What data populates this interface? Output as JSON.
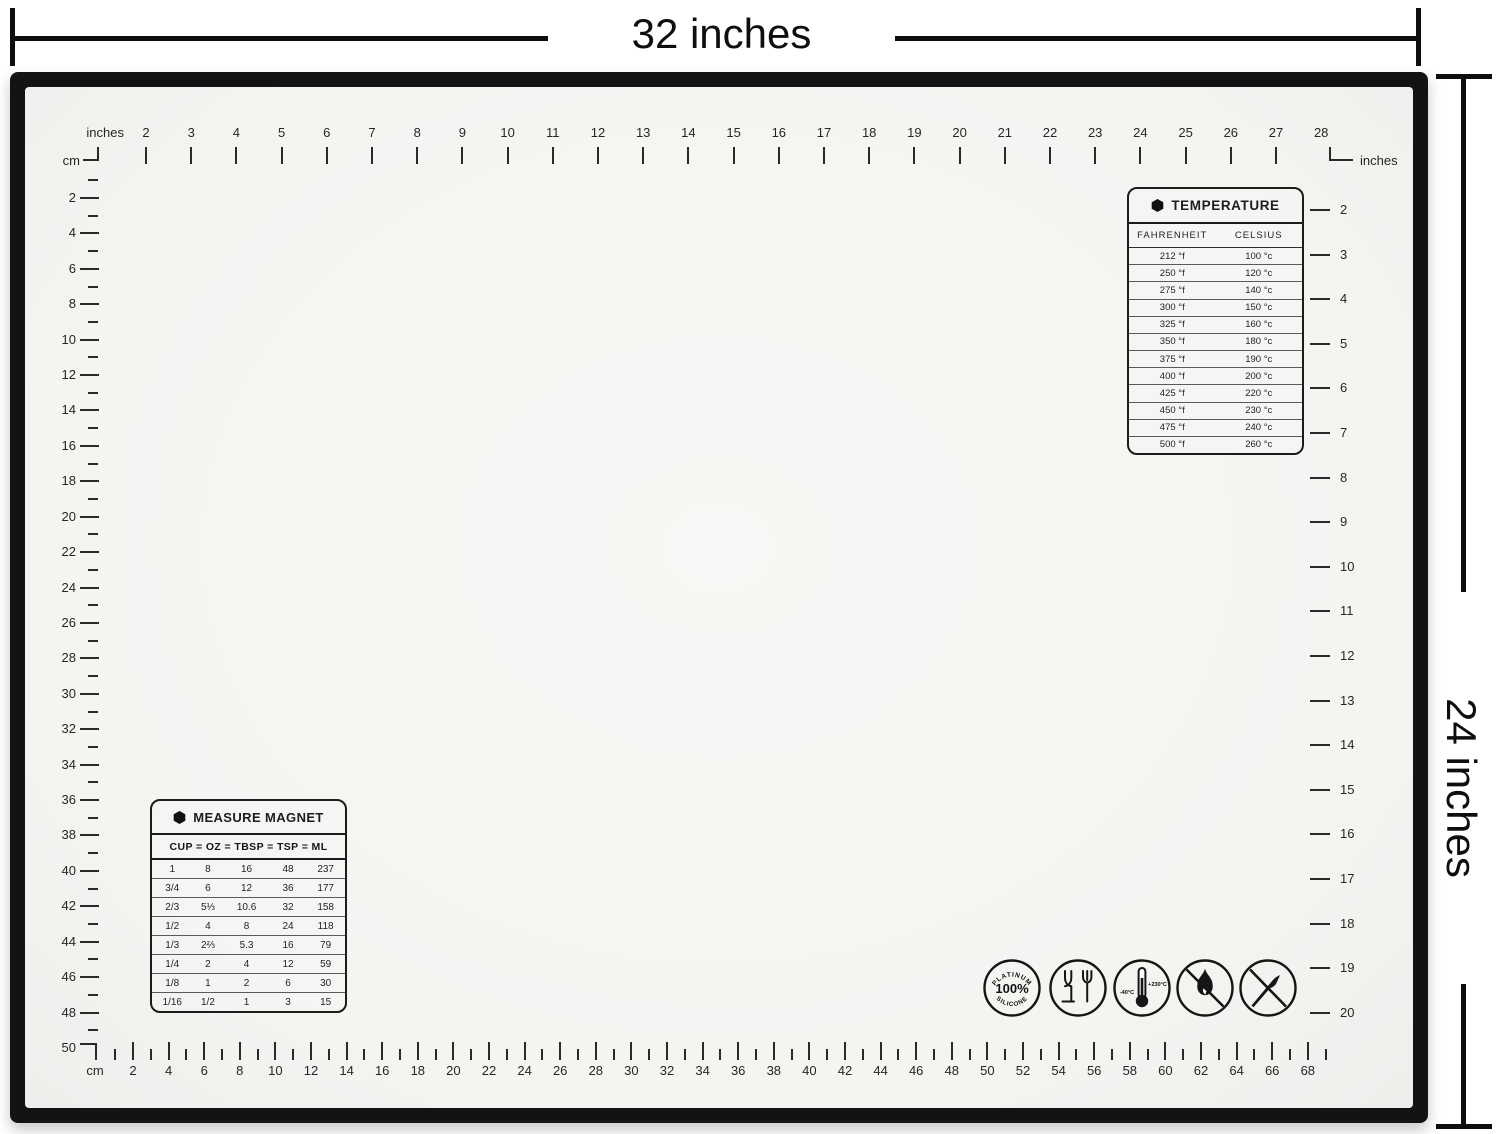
{
  "dimensions": {
    "width_label": "32 inches",
    "height_label": "24 inches"
  },
  "rulers": {
    "top": {
      "unit_label": "inches",
      "numbers": [
        2,
        3,
        4,
        5,
        6,
        7,
        8,
        9,
        10,
        11,
        12,
        13,
        14,
        15,
        16,
        17,
        18,
        19,
        20,
        21,
        22,
        23,
        24,
        25,
        26,
        27,
        28
      ]
    },
    "left": {
      "unit_label": "cm",
      "numbers": [
        2,
        4,
        6,
        8,
        10,
        12,
        14,
        16,
        18,
        20,
        22,
        24,
        26,
        28,
        30,
        32,
        34,
        36,
        38,
        40,
        42,
        44,
        46,
        48,
        50
      ]
    },
    "right": {
      "unit_label": "inches",
      "numbers": [
        2,
        3,
        4,
        5,
        6,
        7,
        8,
        9,
        10,
        11,
        12,
        13,
        14,
        15,
        16,
        17,
        18,
        19,
        20
      ]
    },
    "bottom": {
      "unit_label": "cm",
      "numbers": [
        2,
        4,
        6,
        8,
        10,
        12,
        14,
        16,
        18,
        20,
        22,
        24,
        26,
        28,
        30,
        32,
        34,
        36,
        38,
        40,
        42,
        44,
        46,
        48,
        50,
        52,
        54,
        56,
        58,
        60,
        62,
        64,
        66,
        68
      ]
    }
  },
  "circle_guide": {
    "left_unit_label": "inches",
    "right_unit_label": "cm",
    "inch_labels": [
      "18\"",
      "17\"",
      "16\"",
      "15\"",
      "14\"",
      "13\"",
      "12\"",
      "11\"",
      "10\"",
      "9\"",
      "8\"",
      "7\""
    ],
    "inch_diameters": [
      18,
      17,
      16,
      15,
      14,
      13,
      12,
      11,
      10,
      9,
      8,
      7
    ],
    "cm_labels": [
      "17.5",
      "20",
      "22.5",
      "25",
      "27.5",
      "30",
      "32.5",
      "35",
      "37.5",
      "40",
      "42.5",
      "45"
    ],
    "cm_ring_diameters": [
      7,
      8,
      9,
      10,
      11,
      12,
      13,
      14,
      15,
      16,
      17,
      18
    ]
  },
  "temperature_table": {
    "title": "TEMPERATURE",
    "columns": [
      "FAHRENHEIT",
      "CELSIUS"
    ],
    "rows": [
      [
        "212 °f",
        "100 °c"
      ],
      [
        "250 °f",
        "120 °c"
      ],
      [
        "275 °f",
        "140 °c"
      ],
      [
        "300 °f",
        "150 °c"
      ],
      [
        "325 °f",
        "160 °c"
      ],
      [
        "350 °f",
        "180 °c"
      ],
      [
        "375 °f",
        "190 °c"
      ],
      [
        "400 °f",
        "200 °c"
      ],
      [
        "425 °f",
        "220 °c"
      ],
      [
        "450 °f",
        "230 °c"
      ],
      [
        "475 °f",
        "240 °c"
      ],
      [
        "500 °f",
        "260 °c"
      ]
    ]
  },
  "measure_table": {
    "title": "MEASURE MAGNET",
    "header": "CUP = OZ = TBSP = TSP = ML",
    "rows": [
      [
        "1",
        "8",
        "16",
        "48",
        "237"
      ],
      [
        "3/4",
        "6",
        "12",
        "36",
        "177"
      ],
      [
        "2/3",
        "5⅓",
        "10.6",
        "32",
        "158"
      ],
      [
        "1/2",
        "4",
        "8",
        "24",
        "118"
      ],
      [
        "1/3",
        "2⅔",
        "5.3",
        "16",
        "79"
      ],
      [
        "1/4",
        "2",
        "4",
        "12",
        "59"
      ],
      [
        "1/8",
        "1",
        "2",
        "6",
        "30"
      ],
      [
        "1/16",
        "1/2",
        "1",
        "3",
        "15"
      ]
    ]
  },
  "badges": {
    "silicone": {
      "top": "PLATINUM",
      "center": "100%",
      "bottom": "SILICONE"
    },
    "temp_range": {
      "min": "-40°C",
      "max": "+230°C"
    }
  }
}
